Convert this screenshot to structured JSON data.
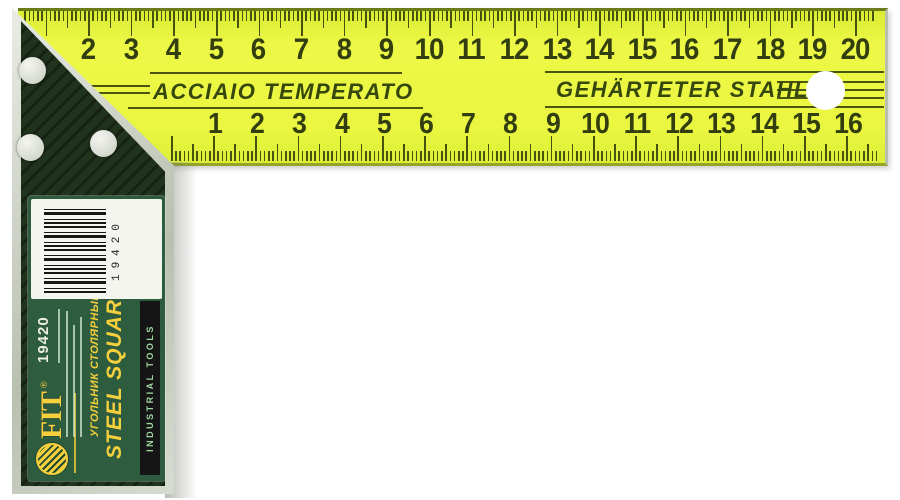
{
  "image_type": "product-photo of a carpenter steel try square",
  "colors": {
    "blade_yellow": "#e9f53f",
    "marking_olive": "#3c480e",
    "handle_green": "#20331d",
    "handle_silver": "#d4d9cd",
    "label_green": "#2d5c3f",
    "label_yellow": "#f6cf3d",
    "bar_black": "#151515",
    "background": "#ffffff"
  },
  "blade": {
    "top_scale": [
      2,
      3,
      4,
      5,
      6,
      7,
      8,
      9,
      10,
      11,
      12,
      13,
      14,
      15,
      16,
      17,
      18,
      19,
      20
    ],
    "bottom_scale": [
      1,
      2,
      3,
      4,
      5,
      6,
      7,
      8,
      9,
      10,
      11,
      12,
      13,
      14,
      15,
      16
    ],
    "brand_text_left": "ACCIAIO TEMPERATO",
    "brand_text_right": "GEHÄRTETER STAHL"
  },
  "label": {
    "sku": "19420",
    "barcode_digits": "19420",
    "product_name_ru": "УГОЛЬНИК СТОЛЯРНЫЙ",
    "product_name_en": "STEEL SQUARE",
    "black_bar_text": "INDUSTRIAL TOOLS",
    "brand": "FIT",
    "registered_mark": "®"
  }
}
